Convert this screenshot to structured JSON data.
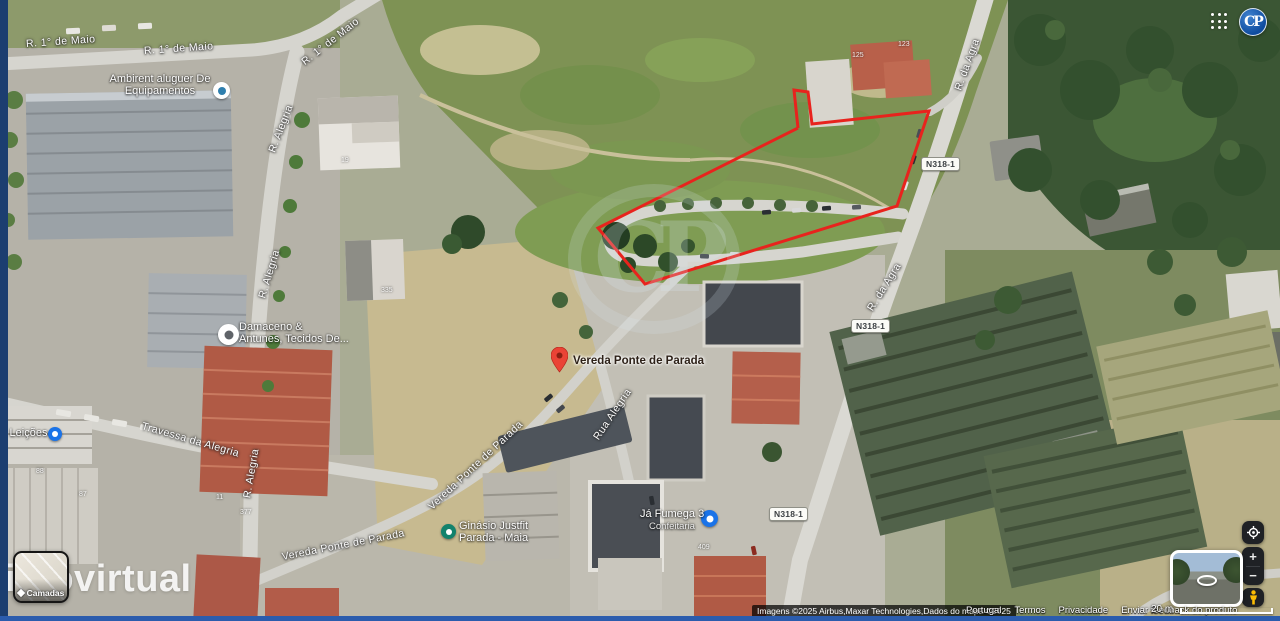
{
  "header": {
    "logo_text": "CP"
  },
  "watermarks": {
    "site": "imovirtual",
    "center_logo": "CP"
  },
  "map": {
    "road_labels": [
      "R. 1° de Maio",
      "R. 1° de Maio",
      "R. 1° de Maio",
      "R. Alegria",
      "R. Alegria",
      "R. Alegria",
      "Travessa da Alegria",
      "R. da Agra",
      "R. da Agra",
      "Rua Alegria",
      "Vereda Ponte de Parada",
      "Vereda Ponte de Parada"
    ],
    "route_badge": "N318-1",
    "pin_label": "Vereda Ponte de Parada",
    "businesses": [
      {
        "line1": "Ambirent aluguer De",
        "line2": "Equipamentos"
      },
      {
        "line1": "Damaceno &",
        "line2": "Antunes, Tecidos De..."
      },
      {
        "line1": "Ginásio Justfit",
        "line2": "Parada - Maia"
      },
      {
        "line1": "Já Fumega 3",
        "line2": "Confeitaria"
      },
      {
        "line1": "s Leições",
        "line2": ""
      }
    ],
    "house_numbers": [
      "125",
      "123",
      "19",
      "335",
      "377",
      "11",
      "88",
      "87",
      "409"
    ]
  },
  "controls": {
    "layers": "Camadas",
    "zoom_in": "+",
    "zoom_out": "−",
    "scale": "20 m"
  },
  "attribution": {
    "imagery": "Imagens ©2025 Airbus,Maxar Technologies,Dados do mapa ©2025",
    "links": [
      "Portugal",
      "Termos",
      "Privacidade",
      "Enviar feedback do produto"
    ]
  },
  "colors": {
    "boundary_red": "#e8231d",
    "frame_blue": "#1c3e70",
    "bottom_blue": "#2b5cad"
  }
}
